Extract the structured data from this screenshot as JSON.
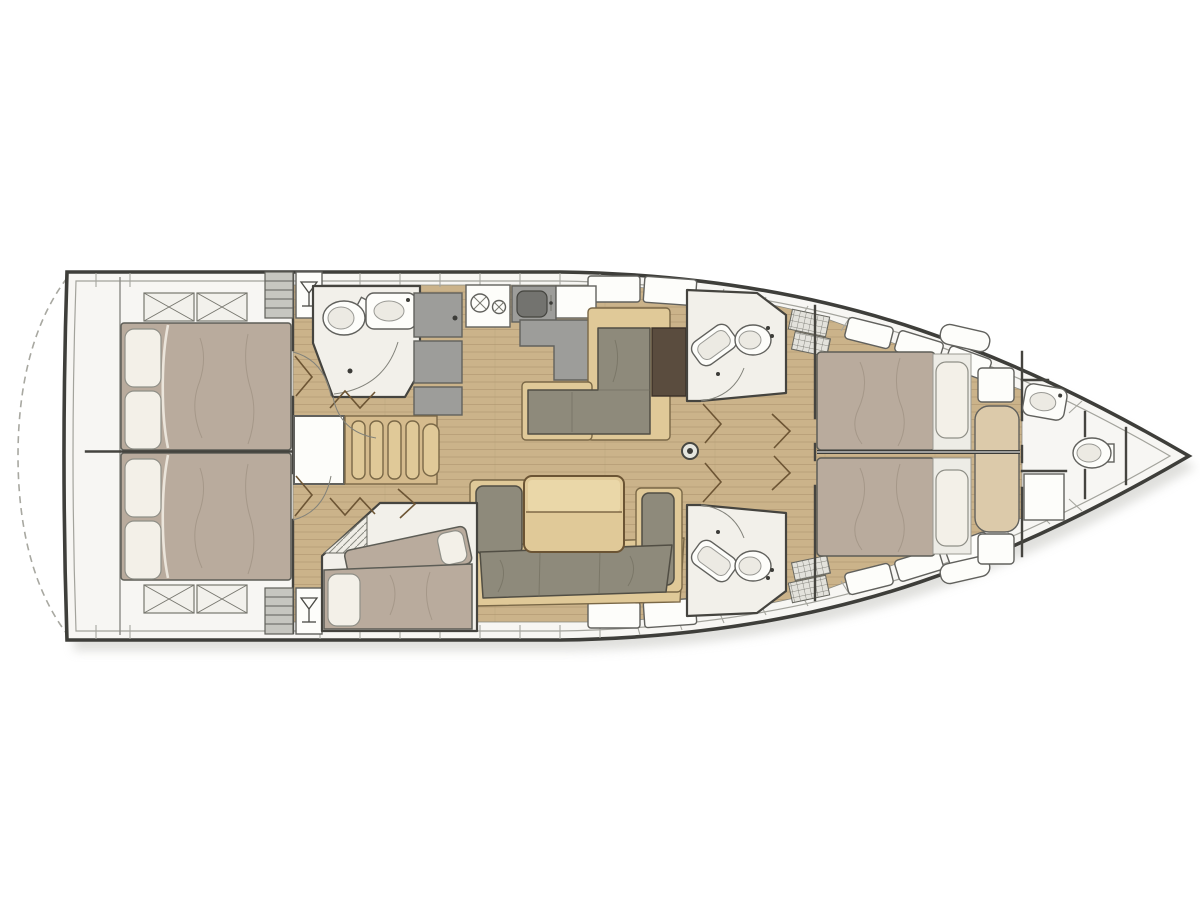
{
  "canvas": {
    "width": 1200,
    "height": 900
  },
  "diagram": {
    "kind": "sailing-yacht-interior-floor-plan",
    "orientation": "bow-right",
    "areas": [
      "swim-platform",
      "aft-cabin-port",
      "aft-cabin-starboard",
      "aft-head",
      "galley",
      "nav-station",
      "saloon",
      "mid-cabin",
      "mid-head-starboard",
      "mid-head-port",
      "forward-cabin-starboard",
      "forward-cabin-port",
      "forward-head",
      "anchor-locker"
    ],
    "fixtures": [
      "double-bed",
      "single-bed",
      "pillow",
      "toilet",
      "washbasin",
      "shower",
      "stove",
      "sink",
      "fridge-cabinet",
      "counter",
      "chart-table",
      "l-sofa",
      "u-sofa",
      "saloon-table",
      "companionway-stairs",
      "mast-post",
      "deck-hatch",
      "skylight-hatch",
      "shelf-locker",
      "wet-bar"
    ]
  },
  "colors": {
    "outline": "#3e3e3a",
    "deck": "#f7f6f3",
    "shadow": "#cfcfca",
    "room": "#f2f0ea",
    "wall": "#45443f",
    "bed": "#b9ab9d",
    "bed_dark": "#8f8171",
    "pillow": "#f3f0e8",
    "sofa": "#8e8a7b",
    "wood_floor": "#cbb38a",
    "plank": "#a98f6a",
    "wood_light": "#e0c998",
    "wood_mid": "#d5bb8d",
    "cabinet": "#9d9d9a",
    "basin": "#73736f",
    "chart_table": "#5a4c3e",
    "door": "#6d5534",
    "bench": "#dccaaa"
  }
}
